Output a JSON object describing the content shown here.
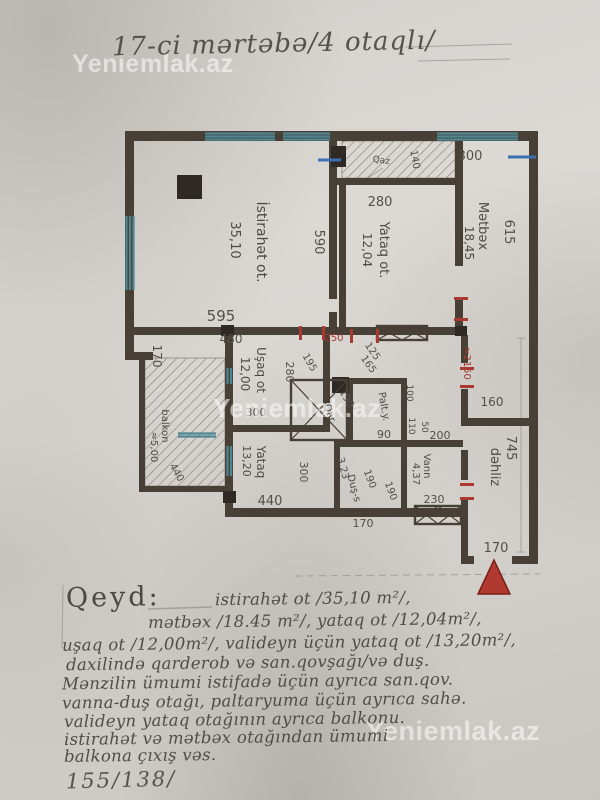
{
  "header": {
    "title": "17-ci mərtəbə/4 otaqlı/"
  },
  "watermark": {
    "text": "Yeniemlak.az"
  },
  "rooms": {
    "istirahat": {
      "name": "İstirahət ot.",
      "area": "35,10"
    },
    "yataq_ot": {
      "name": "Yataq ot.",
      "area": "12,04"
    },
    "metbex": {
      "name": "Mətbəx",
      "area": "18,45"
    },
    "usaq": {
      "name": "Uşaq ot",
      "area": "12,00"
    },
    "yataq2": {
      "name": "Yataq",
      "area": "13,20"
    },
    "balkon": {
      "name": "balkon",
      "area": "≈5,00"
    },
    "qar": {
      "name": "Qar."
    },
    "palty": {
      "name": "Palt.y."
    },
    "dus": {
      "name": "Duş-s",
      "area": "3,23"
    },
    "vann": {
      "name": "Vann",
      "area": "4,37"
    },
    "dehliz": {
      "name": "dəhliz"
    },
    "qaz": {
      "name": "Qaz"
    }
  },
  "dims": {
    "top_300": "300",
    "right_615": "615",
    "qaz_140": "140",
    "yo_280": "280",
    "ist_590": "590",
    "ist_595": "595",
    "usaq_480": "480",
    "left_170": "170",
    "usaq_280": "280",
    "d_195": "195",
    "d_250": "250",
    "d_125": "125",
    "d_165": "165",
    "hall_2150": "≈2150",
    "hall_160": "160",
    "hall_745": "745",
    "hall_170": "170",
    "usaq_300": "300",
    "qar_190": "190",
    "palty_90": "90",
    "palty_100": "100",
    "palty_110": "110",
    "mid_50": "50",
    "mid_200": "200",
    "dus_190": "190",
    "vann_190": "190",
    "dus_170": "170",
    "vann_230": "230",
    "yataq2_300": "300",
    "yataq2_440": "440",
    "balkon_440": "440"
  },
  "note": {
    "label": "Qeyd:",
    "line1": "istirahət ot /35,10 m²/,",
    "line2": "mətbəx /18.45 m²/, yataq ot /12,04m²/,",
    "line3": "uşaq ot /12,00m²/, valideyn üçün yataq ot /13,20m²/,",
    "line4": "daxilində qarderob və san.qovşağı/və duş.",
    "line5": "Mənzilin ümumi istifadə üçün ayrıca san.qov.",
    "line6": "vanna-duş otağı, paltaryuma üçün ayrıca sahə.",
    "line7": "valideyn yataq otağının ayrıca balkonu.",
    "line8": "istirahət və mətbəx otağından ümumi",
    "line9": "balkona çıxış vəs."
  },
  "footer": {
    "ratio": "155/138/"
  }
}
